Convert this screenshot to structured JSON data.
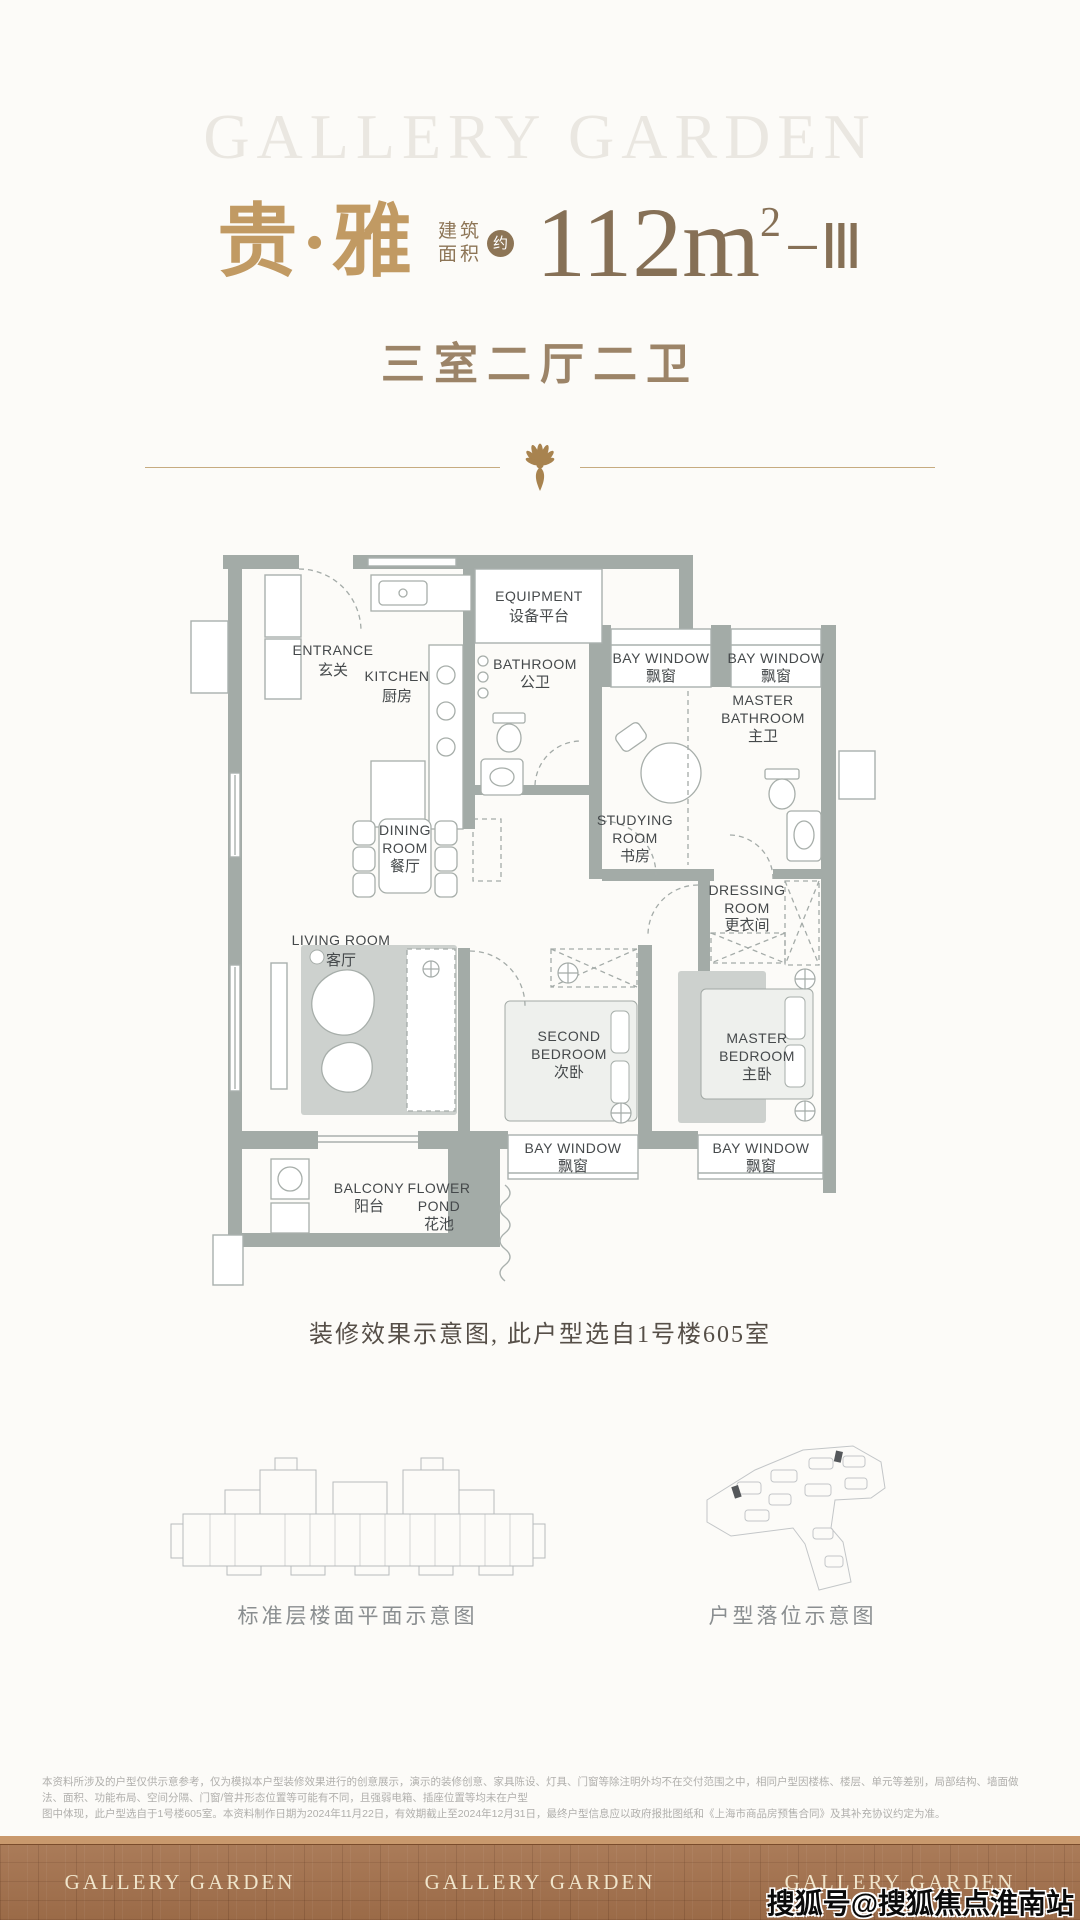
{
  "header": {
    "watermark": "GALLERY GARDEN",
    "name": "贵·雅",
    "area_label_1": "建筑",
    "area_label_2": "面积",
    "area_approx": "约",
    "area_value": "112m",
    "area_sup": "2",
    "area_suffix": "−Ⅲ",
    "subtitle": "三室二厅二卫"
  },
  "floorplan": {
    "rooms": {
      "entrance": {
        "en": "ENTRANCE",
        "zh": "玄关"
      },
      "kitchen": {
        "en": "KITCHEN",
        "zh": "厨房"
      },
      "equipment": {
        "en": "EQUIPMENT",
        "zh": "设备平台"
      },
      "bathroom": {
        "en": "BATHROOM",
        "zh": "公卫"
      },
      "bay_window": {
        "en": "BAY WINDOW",
        "zh": "飘窗"
      },
      "master_bathroom": {
        "en1": "MASTER",
        "en2": "BATHROOM",
        "zh": "主卫"
      },
      "studying_room": {
        "en1": "STUDYING",
        "en2": "ROOM",
        "zh": "书房"
      },
      "dining_room": {
        "en1": "DINING",
        "en2": "ROOM",
        "zh": "餐厅"
      },
      "dressing_room": {
        "en1": "DRESSING",
        "en2": "ROOM",
        "zh": "更衣间"
      },
      "living_room": {
        "en": "LIVING ROOM",
        "zh": "客厅"
      },
      "second_bedroom": {
        "en1": "SECOND",
        "en2": "BEDROOM",
        "zh": "次卧"
      },
      "master_bedroom": {
        "en1": "MASTER",
        "en2": "BEDROOM",
        "zh": "主卧"
      },
      "balcony": {
        "en": "BALCONY",
        "zh": "阳台"
      },
      "flower_pond": {
        "en1": "FLOWER",
        "en2": "POND",
        "zh": "花池"
      }
    },
    "caption": "装修效果示意图, 此户型选自1号楼605室"
  },
  "diagrams": {
    "left_caption": "标准层楼面平面示意图",
    "right_caption": "户型落位示意图"
  },
  "disclaimer": {
    "line1": "本资料所涉及的户型仅供示意参考，仅为模拟本户型装修效果进行的创意展示，演示的装修创意、家具陈设、灯具、门窗等除注明外均不在交付范围之中，相同户型因楼栋、楼层、单元等差别，局部结构、墙面做法、面积、功能布局、空间分隔、门窗/管井形态位置等可能有不同，且强弱电箱、插座位置等均未在户型",
    "line2": "图中体现，此户型选自于1号楼605室。本资料制作日期为2024年11月22日，有效期截止至2024年12月31日，最终户型信息应以政府报批图纸和《上海市商品房预售合同》及其补充协议约定为准。"
  },
  "footer": {
    "brand": "GALLERY GARDEN",
    "watermark": "搜狐号@搜狐焦点淮南站"
  },
  "colors": {
    "gold_title": "#c19a63",
    "brown_value": "#867056",
    "wall_gray": "#a3aba7",
    "footer_brown": "#a4714c",
    "divider_gold": "#c6ab80"
  }
}
